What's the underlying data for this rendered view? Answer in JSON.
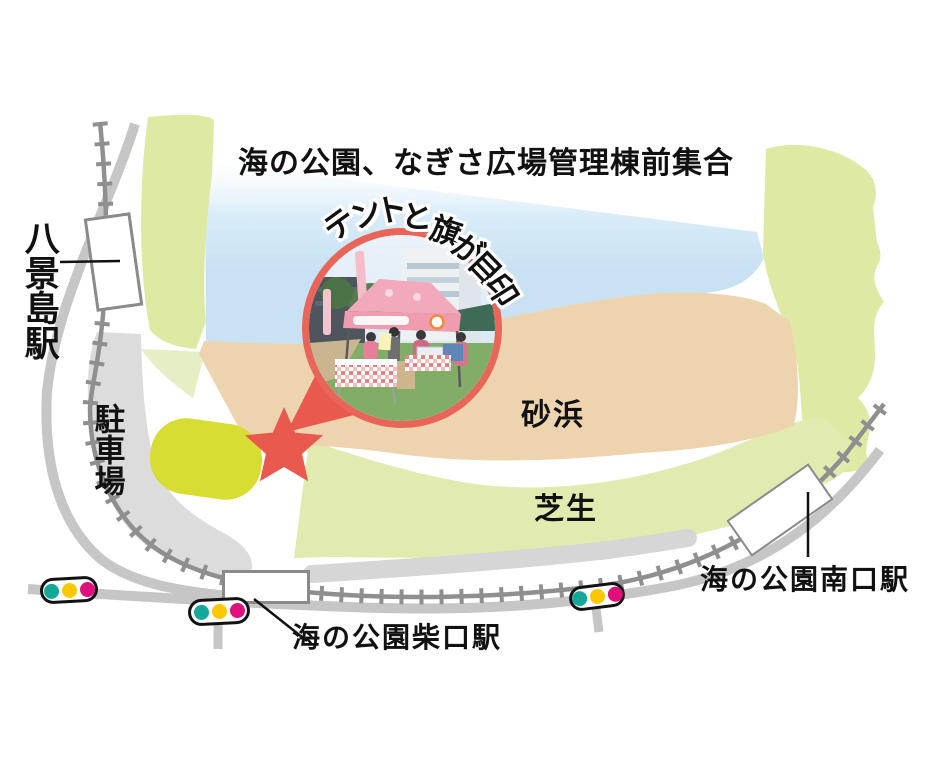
{
  "title": "海の公園、なぎさ広場管理棟前集合",
  "callout": {
    "label": "テントと旗が目印",
    "photo": "tent-and-flags-photo"
  },
  "labels": {
    "beach": "砂浜",
    "lawn": "芝生",
    "parking": "駐車場"
  },
  "stations": {
    "hakkeijima": "八景島駅",
    "shibaguchi": "海の公園柴口駅",
    "minamiguchi": "海の公園南口駅"
  },
  "meeting_marker": {
    "type": "star"
  },
  "traffic_light": {
    "colors": [
      "#16a79b",
      "#fcc800",
      "#df0f7c"
    ]
  },
  "map_colors": {
    "water": "#c9e2f3",
    "park_green": "#dee9a4",
    "park_green_light": "#e6eec6",
    "lawn_green": "#e1ebb0",
    "sand": "#eed4ae",
    "parking_gray": "#dcdcdc",
    "band_gray": "#d6d6d6",
    "road_gray": "#c6c6c6",
    "rail_gray": "#8f8f8f",
    "marker_red": "#e9594e",
    "highlight_yellow": "#d7dd33"
  }
}
